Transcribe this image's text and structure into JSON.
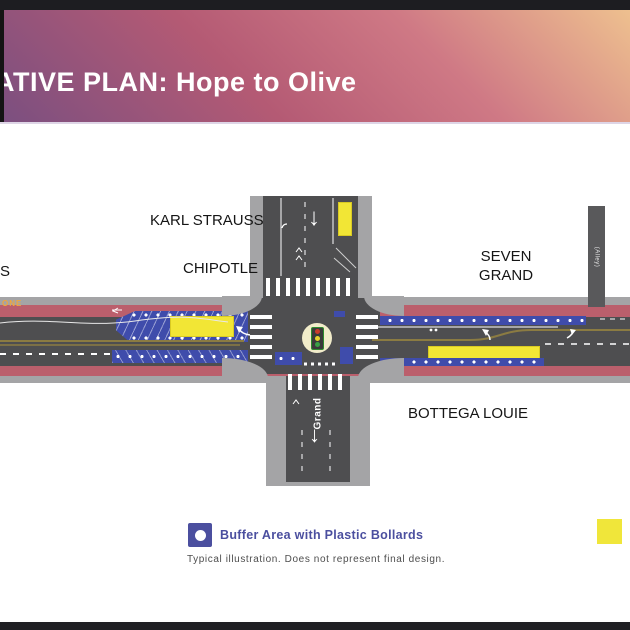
{
  "header": {
    "title": "ATIVE PLAN: Hope to Olive"
  },
  "map": {
    "street_labels": {
      "cross_street": "Grand",
      "alley": "(Alley)",
      "curb_marking": "ONE"
    },
    "business_labels": {
      "left_partial": "S",
      "karl_strauss": "KARL STRAUSS",
      "chipotle": "CHIPOTLE",
      "seven_grand": "SEVEN\nGRAND",
      "bottega_louie": "BOTTEGA LOUIE"
    },
    "glyphs": {
      "down_arrow": "↓"
    },
    "colors": {
      "road": "#4e4e50",
      "sidewalk": "#a4a4a6",
      "curb_red": "#bb5f6c",
      "buffer_blue": "#3f4cab",
      "loading_yellow": "#f2e635",
      "center_line_olive": "#8b7b42",
      "header_purple": "#7b4f80",
      "header_orange": "#eec08f"
    }
  },
  "legend": {
    "items": [
      {
        "id": "buffer-bollards",
        "label": "Buffer Area with Plastic Bollards",
        "color": "#4b4f9f"
      },
      {
        "id": "loading-zone",
        "label": "",
        "color": "#f0e63a"
      }
    ],
    "disclaimer": "Typical illustration. Does not represent final design."
  }
}
